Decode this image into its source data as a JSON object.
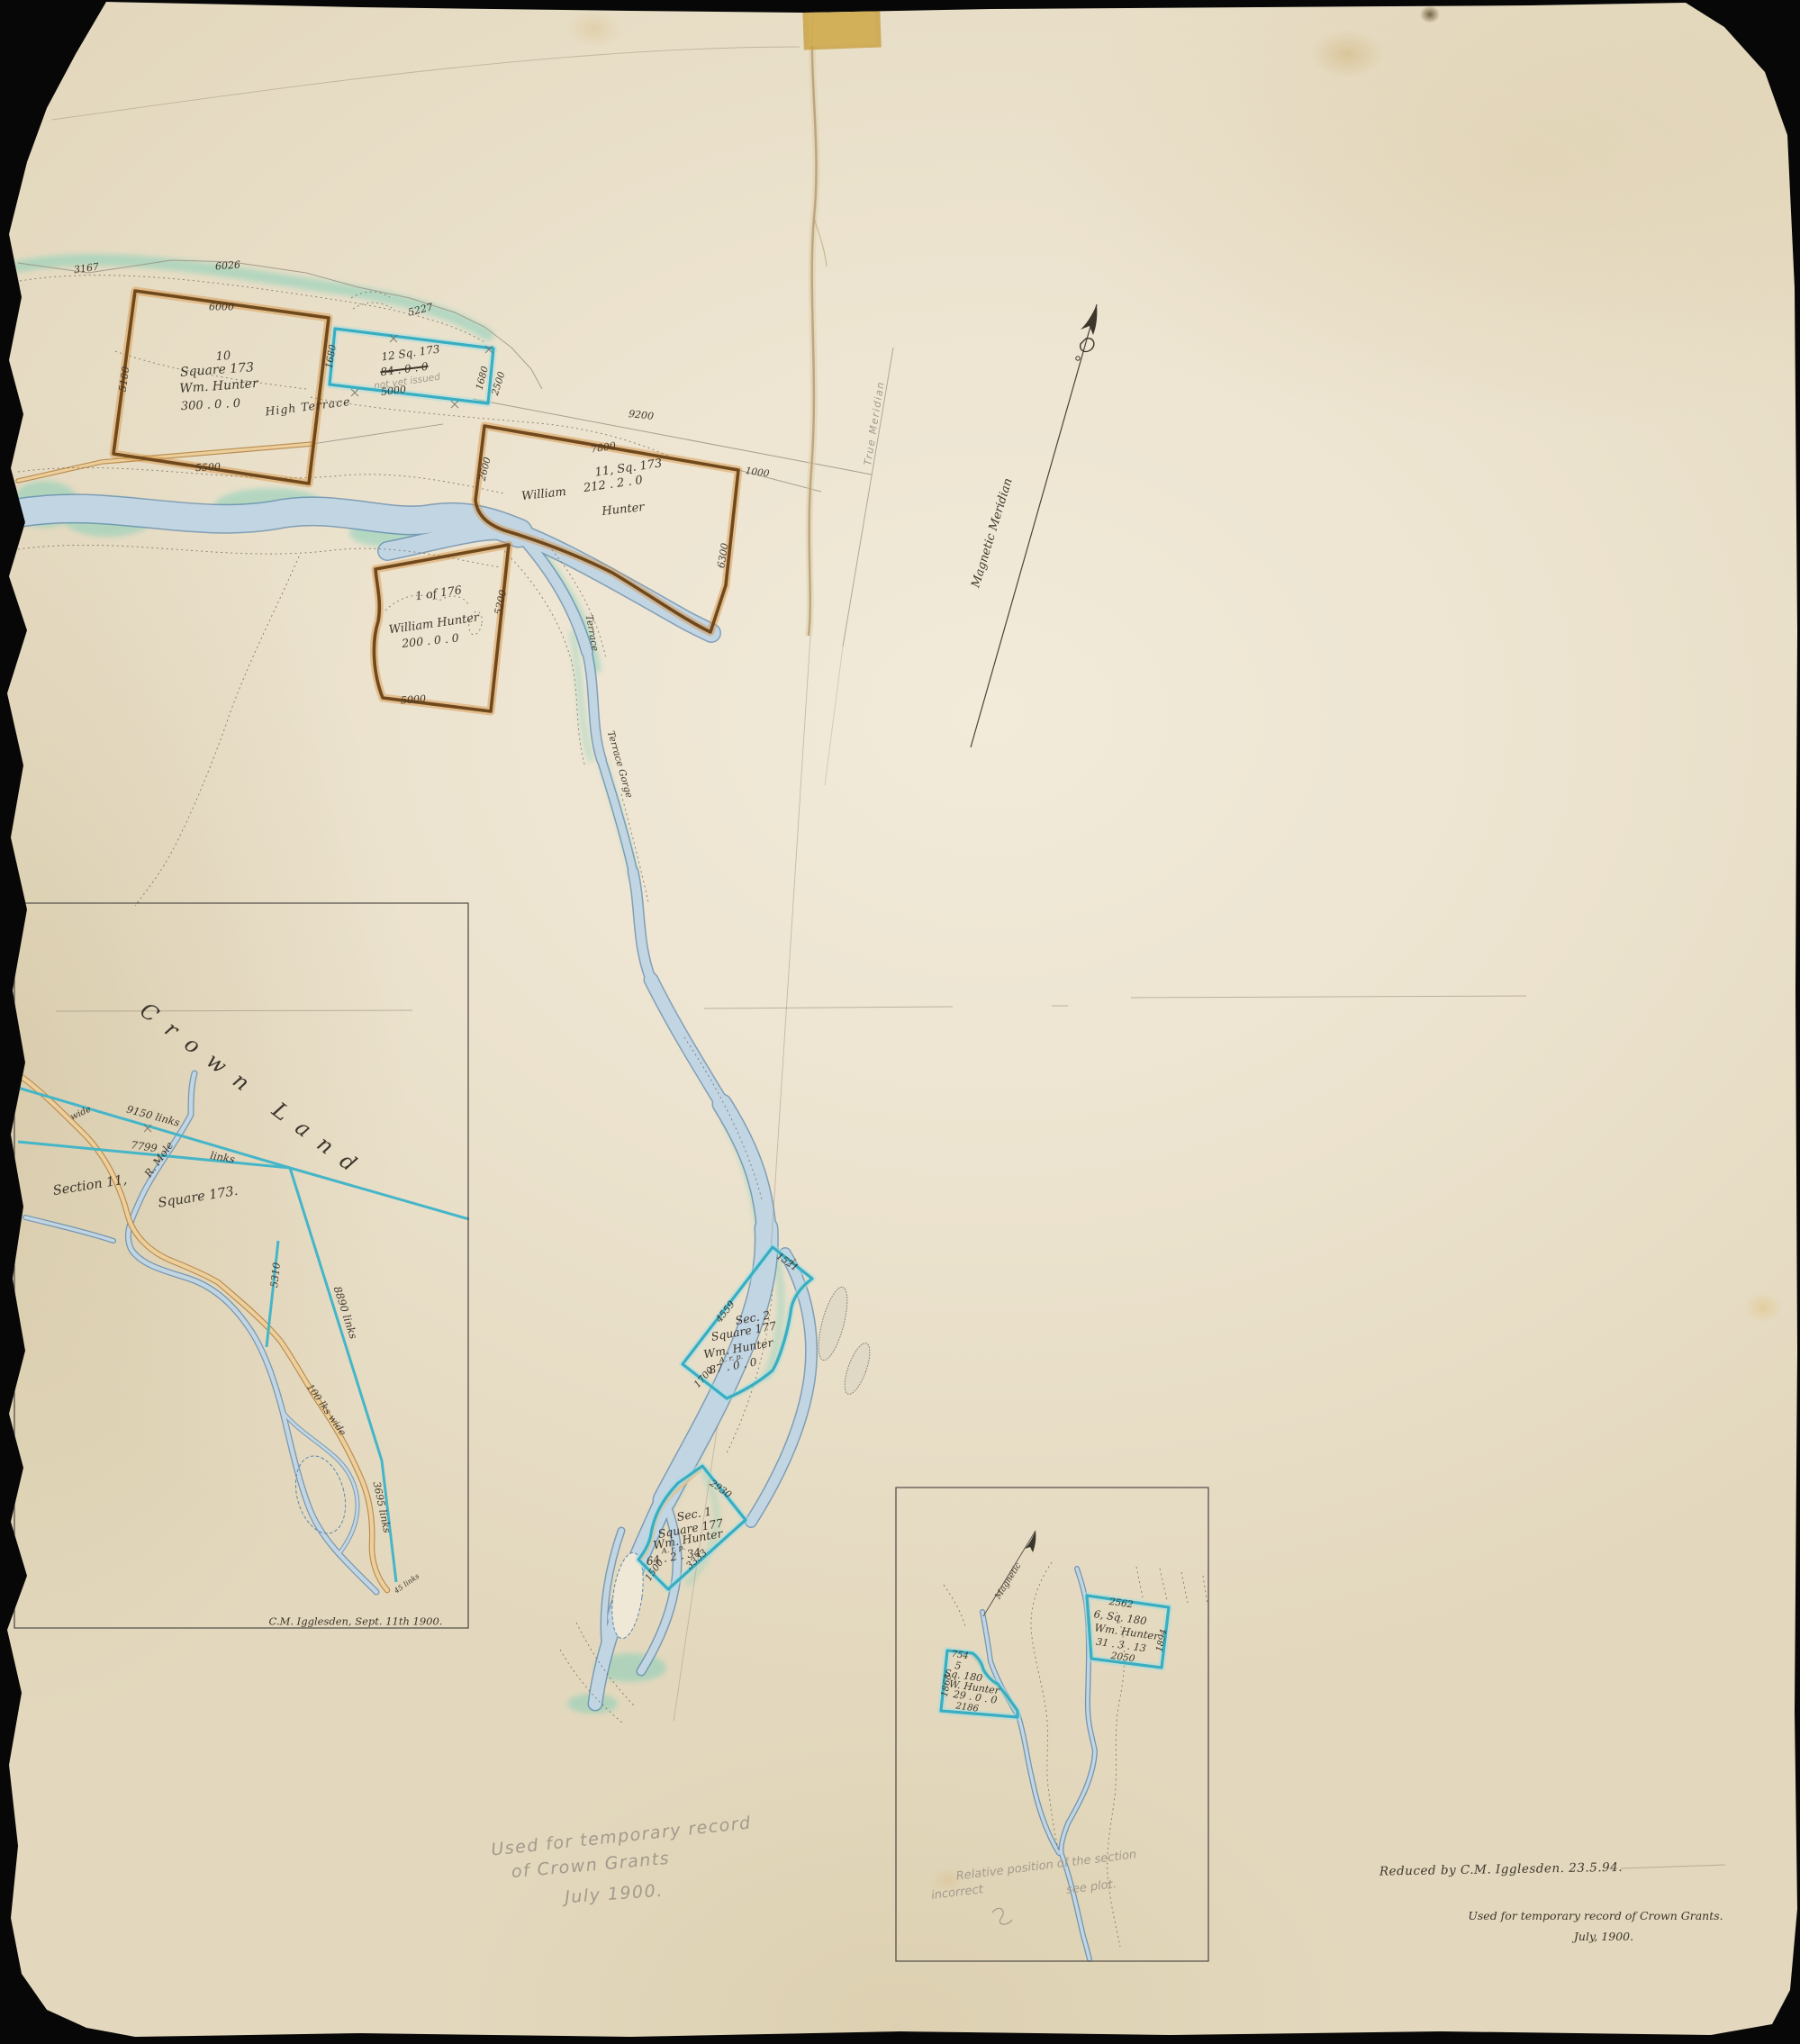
{
  "main_map": {
    "ridge": {
      "n3167": "3167",
      "n6026": "6026",
      "n5227": "5227"
    },
    "high_terrace": "High Terrace",
    "parcel10": {
      "number": "10",
      "square": "Square 173",
      "owner": "Wm. Hunter",
      "area": "300 . 0 . 0",
      "dim_top": "6000",
      "dim_bottom": "5500",
      "dim_left": "5100"
    },
    "parcel12": {
      "title": "12 Sq. 173",
      "area_cancelled": "84 . 0 . 0",
      "pencil_note": "not yet issued",
      "dim_bottom": "5000",
      "dim_left": "1680",
      "dim_right_a": "1680",
      "dim_right_b": "2500"
    },
    "parcel11": {
      "title": "11, Sq. 173",
      "area": "212 . 2 . 0",
      "owner_line1": "William",
      "owner_line2": "Hunter",
      "dim_top": "7800",
      "dim_survey": "9200",
      "dim_right_top": "1000",
      "dim_right": "6300",
      "dim_left": "2600"
    },
    "parcel176": {
      "title": "1 of 176",
      "owner": "William Hunter",
      "area": "200 . 0 . 0",
      "dim_right": "5200",
      "dim_bottom": "5000"
    },
    "magnetic_meridian": "Magnetic Meridian",
    "true_meridian": "True Meridian",
    "river_label_upper": "Terrace",
    "river_label_lower": "Terrace Gorge",
    "sec2": {
      "title": "Sec. 2",
      "square": "Square 177",
      "owner": "Wm. Hunter",
      "arp": "A. r. p.",
      "area": "87 . 0 . 0",
      "dim_top": "1521",
      "dim_left": "4559",
      "dim_bottom": "1700"
    },
    "sec1": {
      "title": "Sec. 1",
      "square": "Square 177",
      "owner": "Wm. Hunter",
      "arp": "A. r. p.",
      "area": "64 . 2 . 34",
      "dim_top": "2930",
      "dim_right": "3333",
      "dim_left": "1500"
    }
  },
  "inset_crown_land": {
    "region": "Crown Land",
    "dim_9150": "9150 links",
    "dim_7799": "7799",
    "links_word": "links",
    "river_name": "R. Mole",
    "section_label": "Section 11,",
    "square_label": "Square 173.",
    "dim_5310": "5310",
    "dim_8890": "8890 links",
    "road_width": "100 lks wide",
    "dim_3695": "3695 links",
    "dim_45": "45 links",
    "road_wide_word": "wide",
    "signature": "C.M. Igglesden, Sept. 11th 1900."
  },
  "inset_square180": {
    "parcel6": {
      "dim_top": "2562",
      "title": "6, Sq. 180",
      "owner": "Wm. Hunter",
      "area": "31 . 3 . 13",
      "dim_bottom": "2050",
      "dim_right": "1894"
    },
    "parcel5": {
      "dim_top": "754",
      "number": "5",
      "square": "Sq. 180",
      "owner": "W. Hunter",
      "area": "29 . 0 . 0",
      "dim_bottom": "2186",
      "dim_left": "1868"
    },
    "magnetic_label": "Magnetic",
    "pencil_note_line1": "Relative position of the section",
    "pencil_note_line2": "incorrect",
    "pencil_note_line3": "see plot."
  },
  "annotations": {
    "pencil_line1": "Used for temporary record",
    "pencil_line2": "of Crown Grants",
    "pencil_line3": "July 1900.",
    "ink_line1": "Reduced by C.M. Igglesden. 23.5.94.",
    "ink_line2": "Used for temporary record of Crown Grants.",
    "ink_line3": "July, 1900."
  },
  "colors": {
    "paper": "#ece3cf",
    "ink": "#3d362c",
    "pencil": "#a29a8c",
    "teal_parcel": "#38aec2",
    "brown_parcel": "#6f481b",
    "river": "#c2d5e3",
    "river_edge": "#5d88ae",
    "green_wash": "#7fceb8",
    "road": "#eccf9c"
  }
}
